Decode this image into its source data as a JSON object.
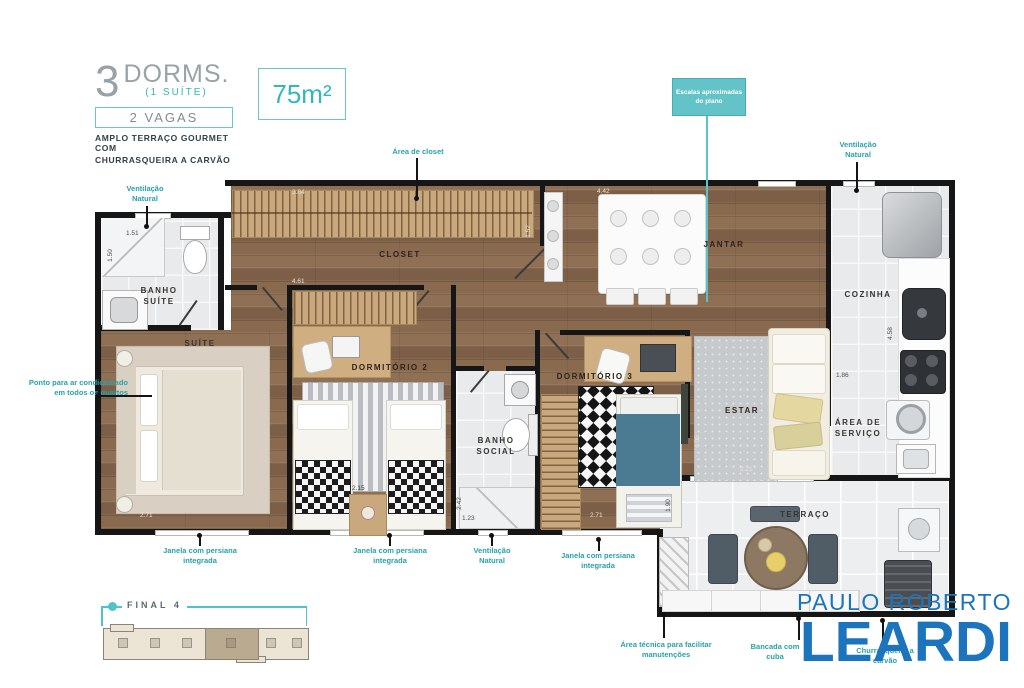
{
  "header": {
    "num": "3",
    "dorms": "DORMS.",
    "suite": "(1 SUÍTE)",
    "vagas": "2 VAGAS",
    "sub1": "AMPLO TERRAÇO GOURMET COM",
    "sub2": "CHURRASQUEIRA A CARVÃO",
    "area": "75m²"
  },
  "callout": {
    "text": "Escalas aproximadas do plano"
  },
  "rooms": {
    "banho_suite": "BANHO SUÍTE",
    "suite": "SUÍTE",
    "closet": "CLOSET",
    "dorm2": "DORMITÓRIO 2",
    "banho_social": "BANHO SOCIAL",
    "dorm3": "DORMITÓRIO 3",
    "jantar": "JANTAR",
    "estar": "ESTAR",
    "cozinha": "COZINHA",
    "area_servico": "ÁREA DE SERVIÇO",
    "terraco": "TERRAÇO"
  },
  "ann": {
    "vent1": "Ventilação Natural",
    "closet_area": "Área de closet",
    "vent2": "Ventilação Natural",
    "ac": "Ponto para ar condicionado em todos os quartos",
    "window1": "Janela com persiana integrada",
    "window2": "Janela com persiana integrada",
    "vent3": "Ventilação Natural",
    "window3": "Janela com persiana integrada",
    "tech": "Área técnica para facilitar manutenções",
    "counter": "Bancada com cuba",
    "grill": "Churrasqueira a carvão"
  },
  "dims": {
    "d1": "1.51",
    "d2": "1.50",
    "d3": "3.84",
    "d4": "4.61",
    "d5": "1.52",
    "d6": "4.42",
    "d7": "2.71",
    "d8": "2.15",
    "d9": "2.42",
    "d10": "1.23",
    "d11": "2.71",
    "d12": "4.05",
    "d13": "2.21",
    "d14": "4.58",
    "d15": "1.86",
    "d16": "1.90"
  },
  "keyplan": {
    "label": "FINAL 4"
  },
  "logo": {
    "line1": "PAULO ROBERTO",
    "line2": "LEARDI"
  },
  "colors": {
    "teal": "#3fbdc2",
    "blue": "#1b74bc",
    "wood": "#87664c",
    "wall": "#161616"
  }
}
